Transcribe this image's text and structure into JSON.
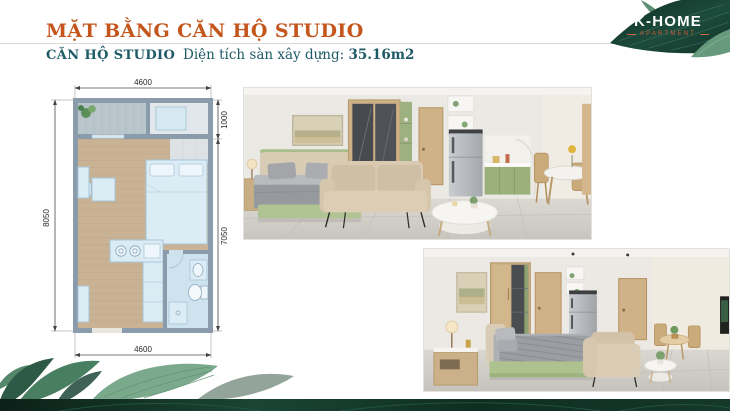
{
  "header": {
    "title": "MẶT BẰNG CĂN HỘ STUDIO",
    "unit_label": "CĂN HỘ STUDIO",
    "area_label": "Diện tích sàn xây dựng:",
    "area_value": "35.16m2"
  },
  "logo": {
    "name": "K-HOME",
    "tagline": "APARTMENT"
  },
  "floorplan": {
    "dim_top": "4600",
    "dim_bottom": "4600",
    "dim_left": "8050",
    "dim_right_upper": "1000",
    "dim_right_lower": "7050"
  },
  "colors": {
    "accent_orange": "#c4561d",
    "accent_teal": "#1d5a66",
    "logo_red": "#d05a3e",
    "leaf_dark": "#11332a",
    "plan_wall": "#8a9bac",
    "plan_fixture_blue": "#dcecf5",
    "cabinet_green": "#9cb07c"
  }
}
